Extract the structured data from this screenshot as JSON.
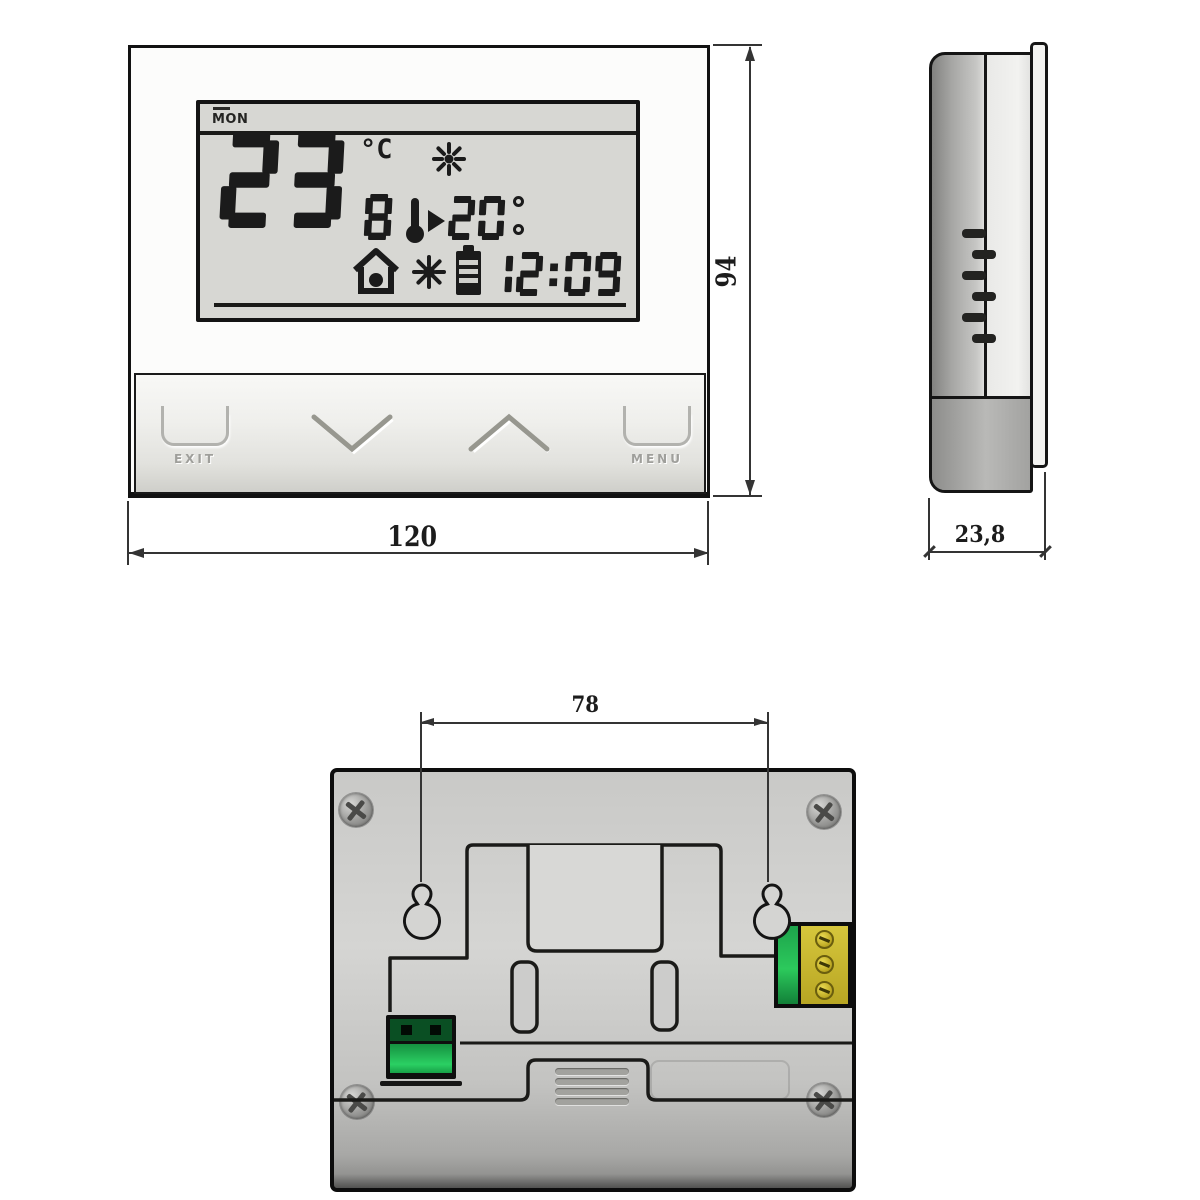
{
  "title": "Digital thermostat dimensional drawing",
  "views": {
    "front": {
      "lcd": {
        "day": "MON",
        "temperature": "23",
        "unit": "°C",
        "period_digit": "8",
        "set_temperature": "20",
        "time": "12:09",
        "icons": [
          "sun-icon",
          "thermometer-icon",
          "arrow-right-icon",
          "house-icon",
          "sun-icon",
          "battery-icon"
        ]
      },
      "buttons": {
        "exit_label": "EXIT",
        "menu_label": "MENU",
        "down_icon": "chevron-down-icon",
        "up_icon": "chevron-up-icon"
      }
    },
    "side": {
      "features": [
        "vent-slots",
        "mounting-flange",
        "battery-cover"
      ]
    },
    "back": {
      "features": [
        "corner-screws",
        "keyhole-mounts",
        "terminal-block",
        "connector-socket",
        "speaker-grille",
        "battery-cover"
      ]
    }
  },
  "dimensions": {
    "front_width_mm": "120",
    "front_height_mm": "94",
    "depth_mm": "23,8",
    "mount_hole_spacing_mm": "78"
  },
  "colors": {
    "outline": "#1b1b1b",
    "lcd_background": "#d7d7d3",
    "connector_green": "#22b455",
    "terminal_yellow": "#cbba2e"
  }
}
